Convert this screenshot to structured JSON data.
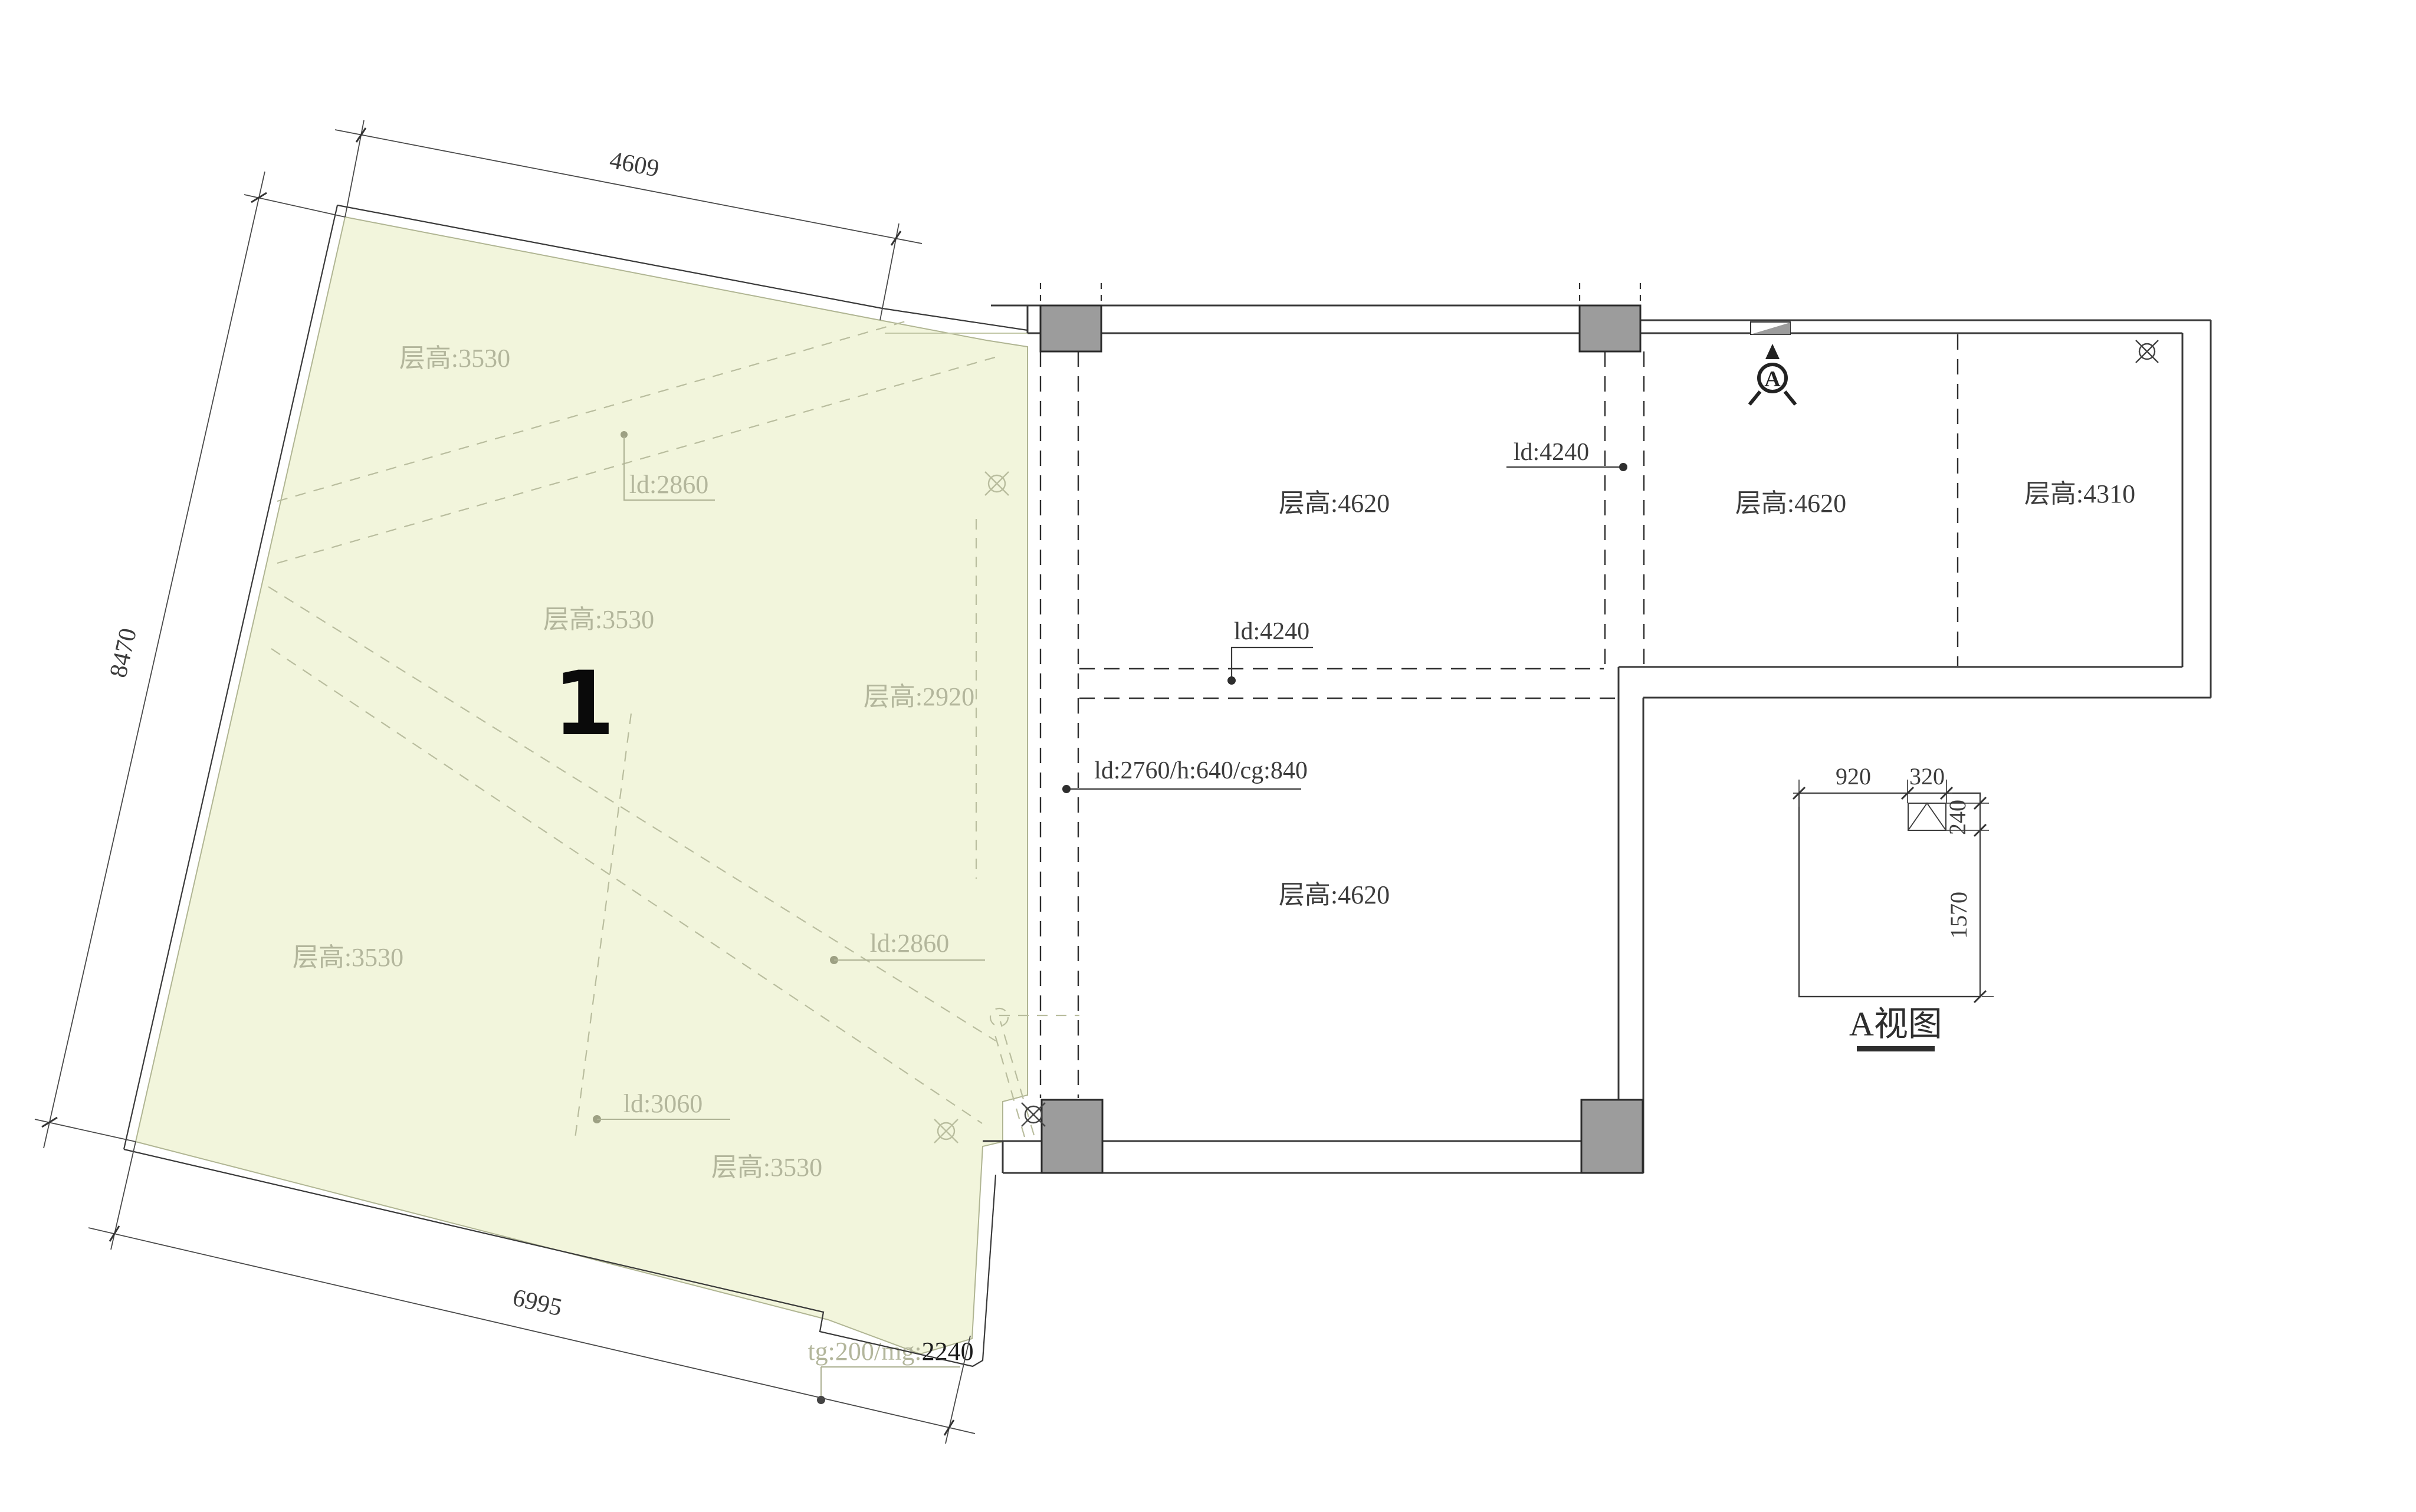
{
  "plan": {
    "zone": {
      "number": "1",
      "height_labels": {
        "top": "层高:3530",
        "mid": "层高:3530",
        "right": "层高:2920",
        "bottom_left": "层高:3530",
        "bottom_mid": "层高:3530"
      },
      "leaders": {
        "top": "ld:2860",
        "right": "ld:2860",
        "bottom": "ld:3060"
      },
      "threshold": {
        "prefix": "tg:200/mg:",
        "value": "2240"
      }
    },
    "outer_dims": {
      "top": "4609",
      "left": "8470",
      "bottom": "6995"
    },
    "rooms": {
      "top_left": "层高:4620",
      "top_right": "层高:4620",
      "far_right": "层高:4310",
      "bottom": "层高:4620"
    },
    "ceiling_leaders": {
      "top": "ld:4240",
      "mid": "ld:4240",
      "beam": "ld:2760/h:640/cg:840"
    },
    "view_marker": "A",
    "detail": {
      "title": "A视图",
      "dim_920": "920",
      "dim_320": "320",
      "dim_240": "240",
      "dim_1570": "1570"
    }
  },
  "colors": {
    "zone_fill": "#f2f5dc",
    "zone_edge": "#b0b593",
    "faint_text": "#b3b69c",
    "wall": "#3a3a3a",
    "column": "#9c9c9c"
  }
}
